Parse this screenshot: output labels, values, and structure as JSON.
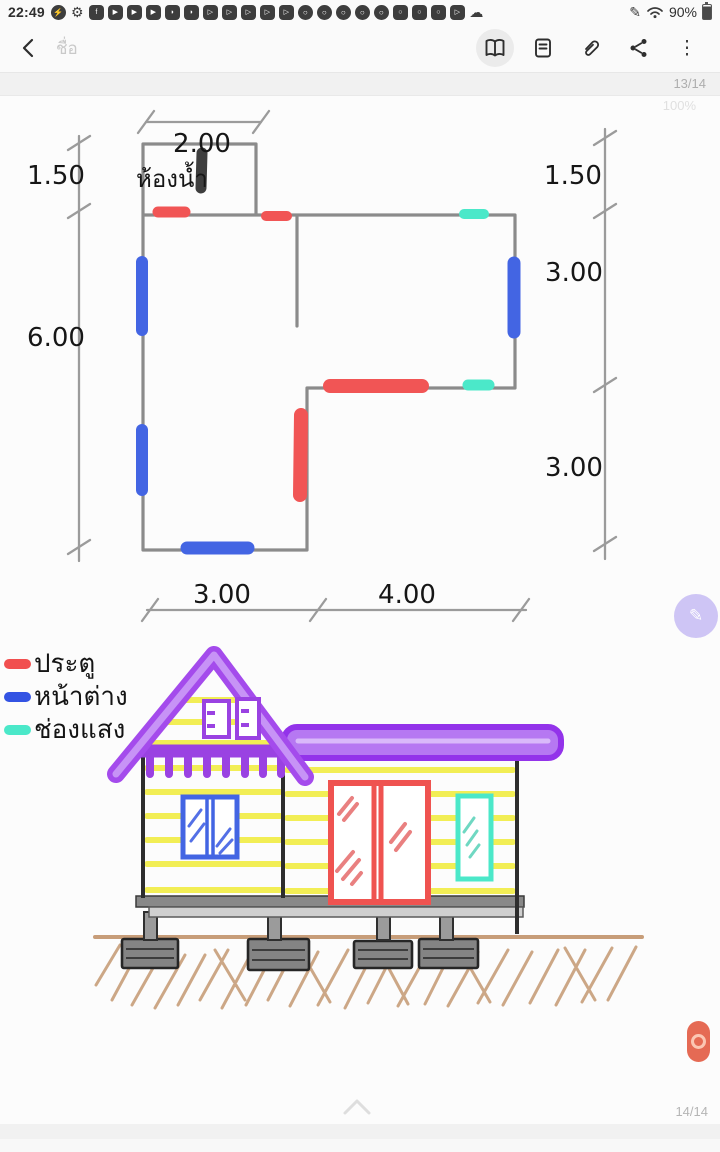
{
  "status_bar": {
    "time": "22:49",
    "battery_percent": "90%",
    "icons": [
      "messenger",
      "settings",
      "facebook",
      "youtube",
      "youtube",
      "youtube",
      "megaphone",
      "megaphone",
      "video",
      "video",
      "video",
      "video",
      "video",
      "chrome",
      "chrome",
      "chrome",
      "chrome",
      "chrome",
      "instagram",
      "instagram",
      "instagram",
      "video",
      "cloud"
    ]
  },
  "toolbar": {
    "title_placeholder": "ชื่อ",
    "page_indicator": "13/14",
    "zoom_level": "100%"
  },
  "note_page": {
    "floor_plan": {
      "room_label": "ห้องน้ำ",
      "dim_top_width": "2.00",
      "dim_left_upper": "1.50",
      "dim_left_total": "6.00",
      "dim_right_upper": "1.50",
      "dim_right_middle": "3.00",
      "dim_right_lower": "3.00",
      "dim_bottom_left": "3.00",
      "dim_bottom_right": "4.00"
    },
    "legend": {
      "items": [
        {
          "label": "ประตู",
          "color": "#f14f4f"
        },
        {
          "label": "หน้าต่าง",
          "color": "#3353e3"
        },
        {
          "label": "ช่องแสง",
          "color": "#4be8c9"
        }
      ]
    },
    "palette": {
      "door_red": "#f15555",
      "window_blue": "#4365e3",
      "light_cyan": "#4be8c9",
      "roof_purple": "#a44bec",
      "siding_yellow": "#f2ee55",
      "ground_brown": "#c79d79",
      "wall_gray": "#8b8b8b"
    }
  },
  "footer": {
    "page_indicator": "14/14"
  }
}
